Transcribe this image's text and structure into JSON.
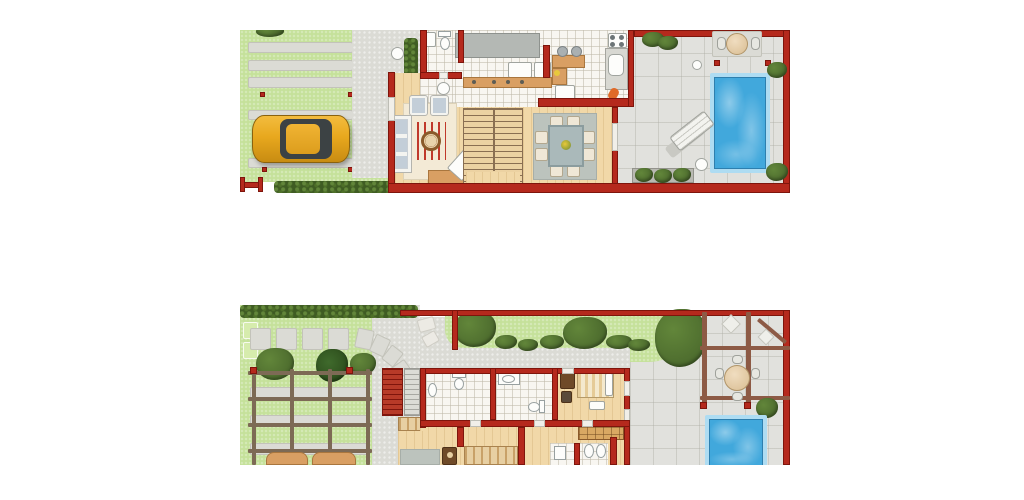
{
  "image": {
    "type": "architectural-floor-plans",
    "floors": [
      {
        "id": "ground-floor",
        "features": [
          "carport-lawn",
          "paver-strips",
          "parked-car",
          "entry-gate",
          "hedge",
          "driveway",
          "entry-porch",
          "wc",
          "laundry",
          "kitchen",
          "breakfast-bar",
          "stove",
          "sink",
          "living-room",
          "sofa",
          "armchairs",
          "round-table",
          "tv",
          "staircase",
          "dining-table-8-chairs",
          "terrace",
          "outdoor-table",
          "sun-lounger",
          "swimming-pool",
          "planters"
        ]
      },
      {
        "id": "upper-floor",
        "features": [
          "hedge",
          "stepping-stone-path",
          "trees",
          "pergola-garden",
          "outdoor-seating",
          "exterior-stairs",
          "bathroom-1",
          "bathroom-2",
          "bedroom-1",
          "bedroom-2",
          "bathroom-3",
          "bookshelf",
          "roof-terrace",
          "pergola",
          "round-table-4-chairs",
          "plunge-pool",
          "shrubs"
        ]
      }
    ]
  },
  "palette": {
    "background": "#ffffff",
    "wall_red": "#b5291d",
    "wall_dark": "#7e150c",
    "grass": "#c5e19a",
    "grass_light": "#d6ecad",
    "paver": "#dbdbd5",
    "stone": "#e1e1dd",
    "tile": "#f8f6f1",
    "wood": "#f1d8a8",
    "stair_line": "#8a6f52",
    "counter": "#b4b8b4",
    "tan": "#d99f63",
    "pool_border": "#aedcf2",
    "pool_water": "#41a8dc",
    "hedge": "#3f5c23",
    "hedge_light": "#62863a",
    "tree": "#4d6c2e",
    "beam": "#7d6a55",
    "beam2": "#8d5a45",
    "car_body": "#e8a81e",
    "car_glass": "#3c4244",
    "rug_cream": "#f3ead6",
    "rug_gray": "#bcc3bd",
    "sofa": "#f4f4f0",
    "cushion": "#c3ced8",
    "red_stripe": "#c0392b",
    "brown": "#6f4a28"
  }
}
